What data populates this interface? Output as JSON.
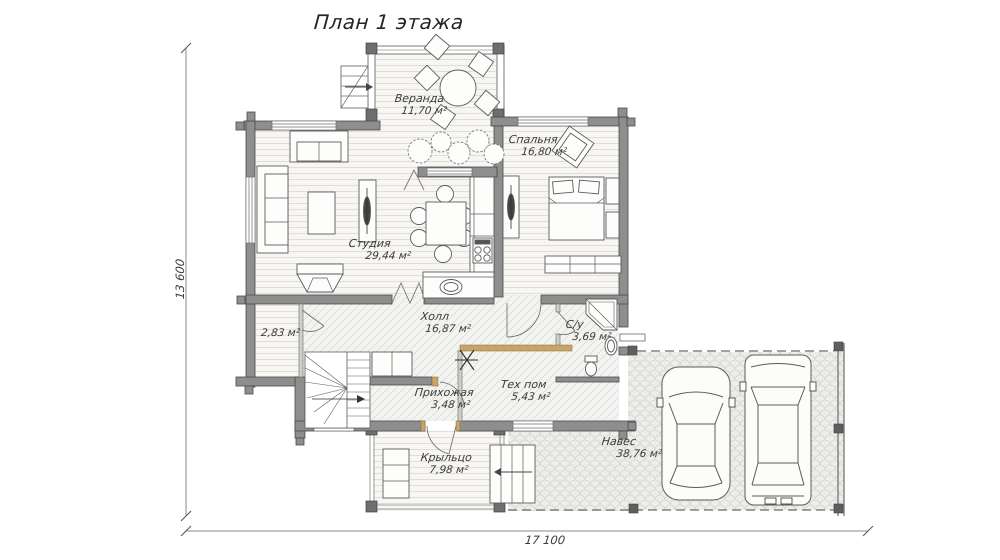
{
  "title": "План 1 этажа",
  "dimensions": {
    "vertical": "13 600",
    "horizontal": "17 100"
  },
  "rooms": [
    {
      "id": "veranda",
      "name": "Веранда",
      "area": "11,70 м²"
    },
    {
      "id": "spalnya",
      "name": "Спальня",
      "area": "16,80 м²"
    },
    {
      "id": "studiya",
      "name": "Студия",
      "area": "29,44 м²"
    },
    {
      "id": "holl",
      "name": "Холл",
      "area": "16,87 м²"
    },
    {
      "id": "su",
      "name": "С/у",
      "area": "3,69 м²"
    },
    {
      "id": "kladovaya",
      "name": "",
      "area": "2,83 м²"
    },
    {
      "id": "tehpom",
      "name": "Тех пом",
      "area": "5,43 м²"
    },
    {
      "id": "prihozhaya",
      "name": "Прихожая",
      "area": "3,48 м²"
    },
    {
      "id": "kryltso",
      "name": "Крыльцо",
      "area": "7,98 м²"
    },
    {
      "id": "naves",
      "name": "Навес",
      "area": "38,76 м²"
    }
  ],
  "colors": {
    "wall": "#8e8e8e",
    "wall_outline": "#4a4a4a",
    "wood_accent": "#c8a469",
    "line": "#5b5b5b",
    "text": "#3a3a3a"
  }
}
